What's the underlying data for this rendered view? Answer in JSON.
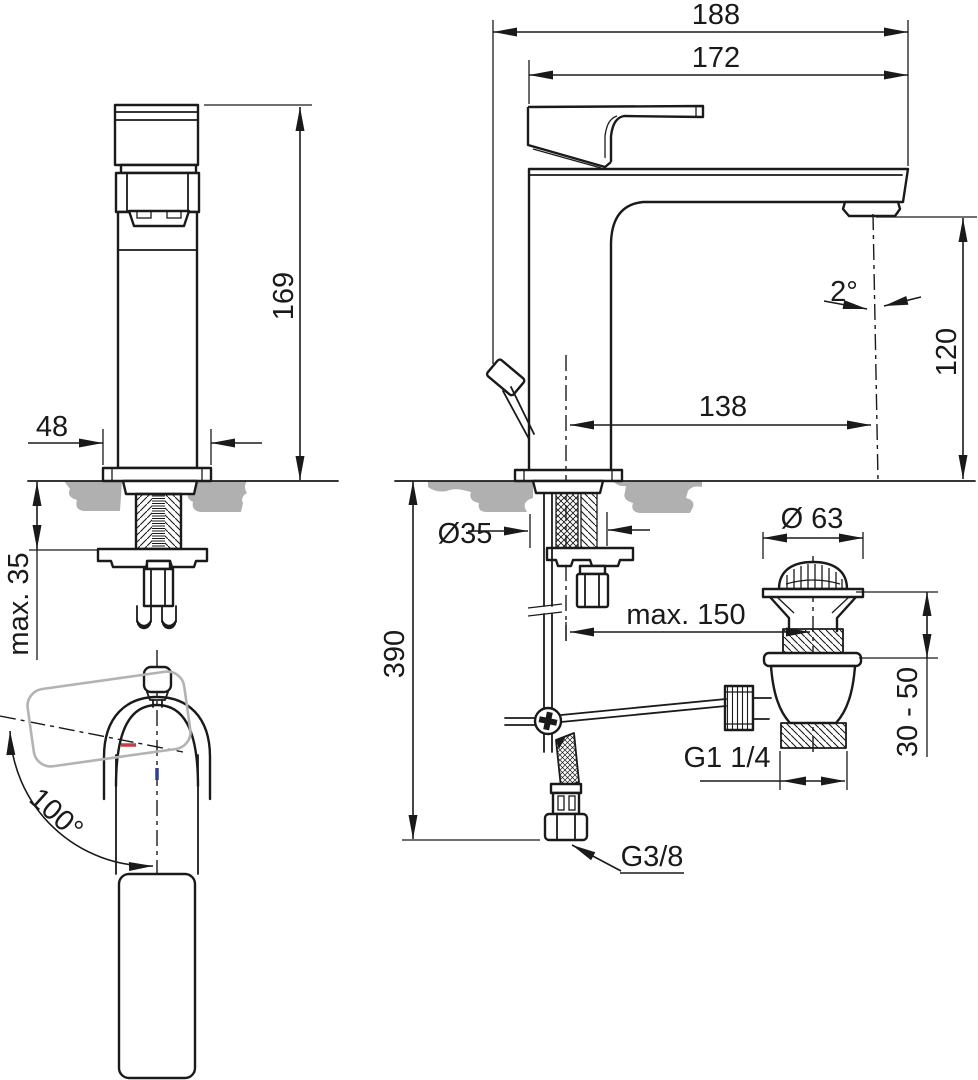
{
  "dims": {
    "total_depth": "188",
    "spout_depth": "172",
    "height": "169",
    "base_width": "48",
    "max_deck_thickness": "max. 35",
    "handle_swivel_angle": "100°",
    "spout_height": "120",
    "spout_reach": "138",
    "stream_angle": "2°",
    "mounting_hole_diameter": "Ø35",
    "hose_drop_length": "390",
    "waste_max_offset": "max. 150",
    "waste_plug_diameter": "Ø 63",
    "basin_clamp_range": "30 - 50",
    "waste_thread": "G1 1/4",
    "supply_hose_thread": "G3/8"
  },
  "colors": {
    "line": "#1a1a1a",
    "counter": "#b0b0b0",
    "ghost": "#b3b3b3",
    "hot": "#c63d45",
    "cold": "#2f3f8f"
  }
}
